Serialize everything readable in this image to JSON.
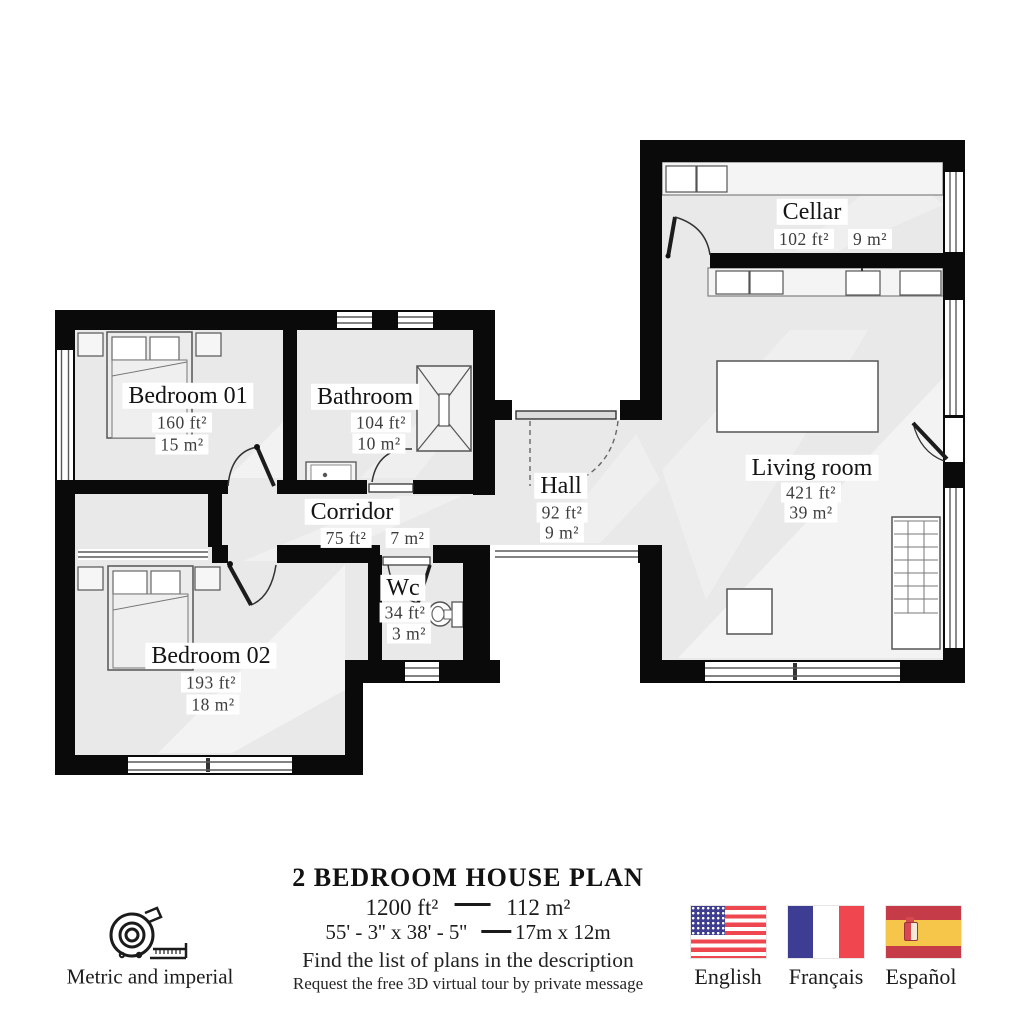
{
  "plan": {
    "rooms": {
      "cellar": {
        "name": "Cellar",
        "ft": "102 ft²",
        "m": "9 m²"
      },
      "living": {
        "name": "Living room",
        "ft": "421 ft²",
        "m": "39 m²"
      },
      "bedroom1": {
        "name": "Bedroom 01",
        "ft": "160 ft²",
        "m": "15 m²"
      },
      "bathroom": {
        "name": "Bathroom",
        "ft": "104 ft²",
        "m": "10 m²"
      },
      "corridor": {
        "name": "Corridor",
        "ft": "75 ft²",
        "m": "7 m²"
      },
      "hall": {
        "name": "Hall",
        "ft": "92 ft²",
        "m": "9 m²"
      },
      "wc": {
        "name": "Wc",
        "ft": "34 ft²",
        "m": "3 m²"
      },
      "bedroom2": {
        "name": "Bedroom 02",
        "ft": "193 ft²",
        "m": "18 m²"
      }
    },
    "colors": {
      "wall": "#0a0a0a",
      "floor": "#e9e9e9"
    }
  },
  "footer": {
    "title": "2 BEDROOM HOUSE PLAN",
    "area_imperial": "1200 ft²",
    "area_metric": "112 m²",
    "dims_imperial": "55' - 3'' x 38' - 5''",
    "dims_metric": "17m x 12m",
    "note1": "Find the list of plans in the description",
    "note2": "Request the free 3D virtual tour by private message",
    "units_label": "Metric and imperial",
    "languages": [
      {
        "label": "English"
      },
      {
        "label": "Français"
      },
      {
        "label": "Español"
      }
    ]
  }
}
